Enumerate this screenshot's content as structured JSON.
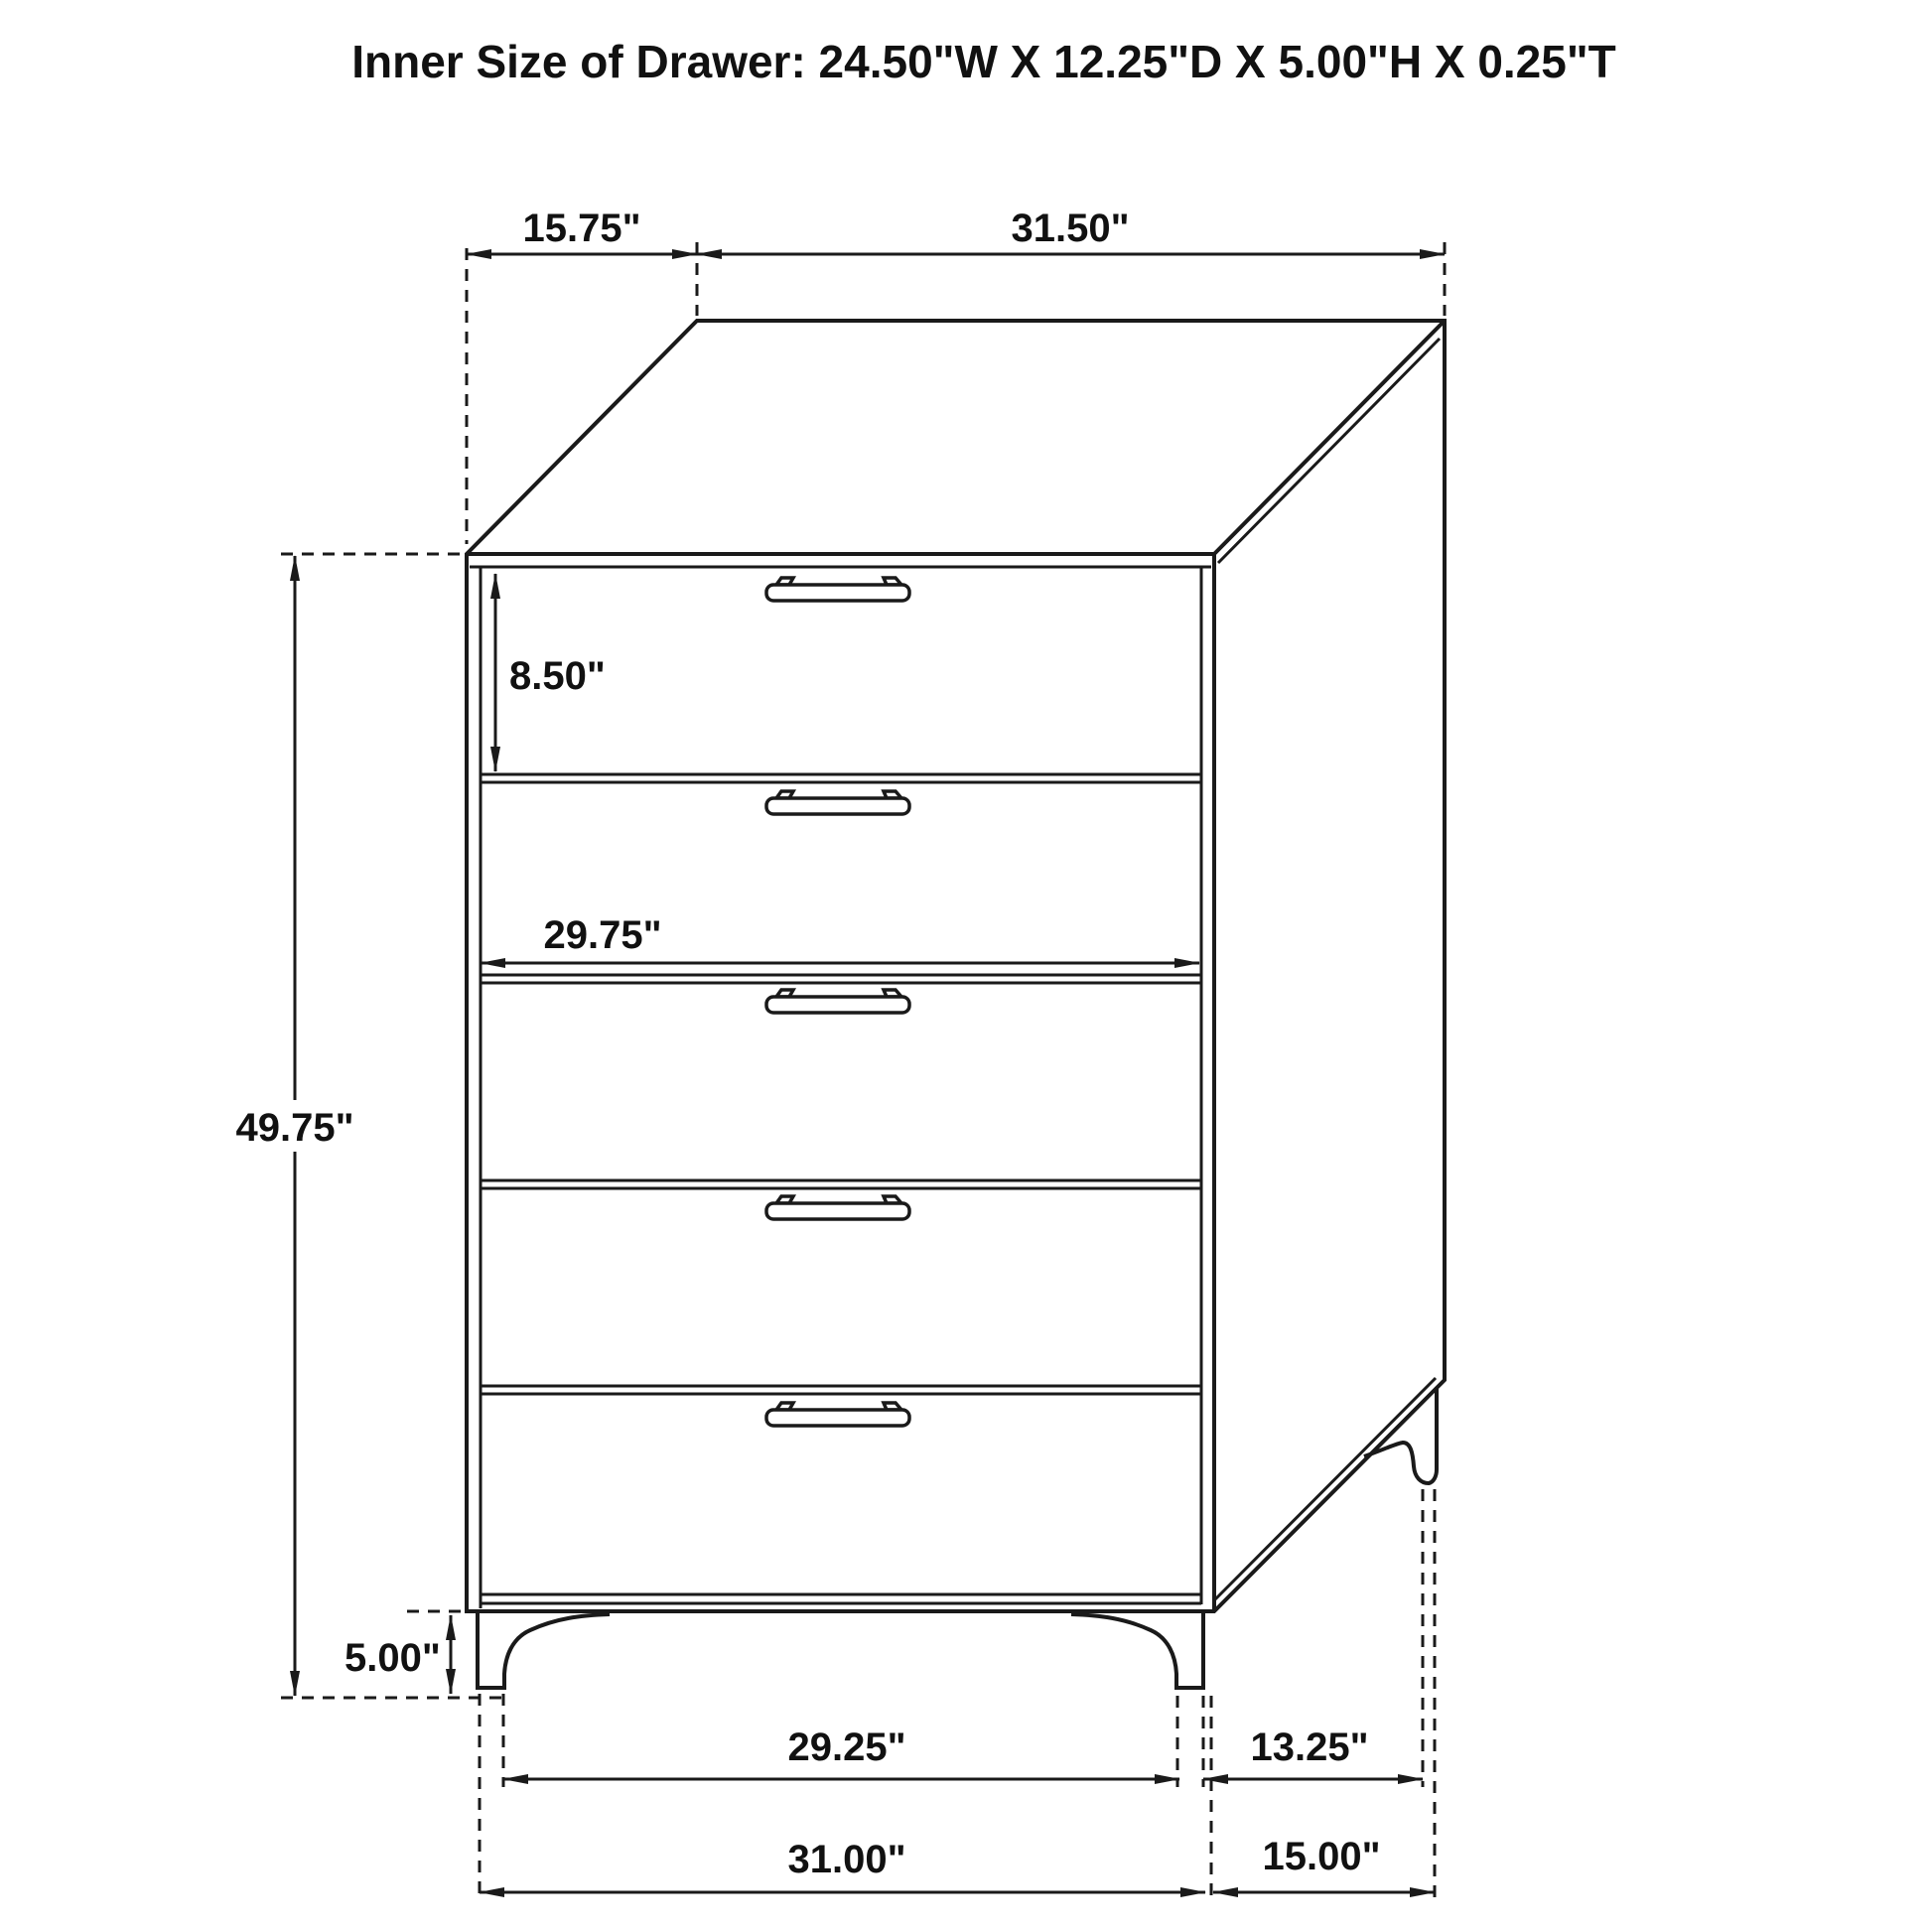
{
  "title": "Inner Size of Drawer: 24.50\"W X 12.25\"D X 5.00\"H X 0.25\"T",
  "diagram": {
    "type": "furniture-dimension-drawing",
    "item": "5-drawer chest",
    "drawer_count": 5,
    "handle_count": 5
  },
  "dimensions": {
    "top_depth": "15.75\"",
    "top_width": "31.50\"",
    "top_drawer_height": "8.50\"",
    "drawer_front_width": "29.75\"",
    "overall_height": "49.75\"",
    "leg_height": "5.00\"",
    "front_leg_inner_span": "29.25\"",
    "side_leg_span": "13.25\"",
    "bottom_front_width": "31.00\"",
    "bottom_side_depth": "15.00\""
  },
  "colors": {
    "line": "#1a1a1a",
    "background": "#ffffff",
    "text": "#111111"
  }
}
